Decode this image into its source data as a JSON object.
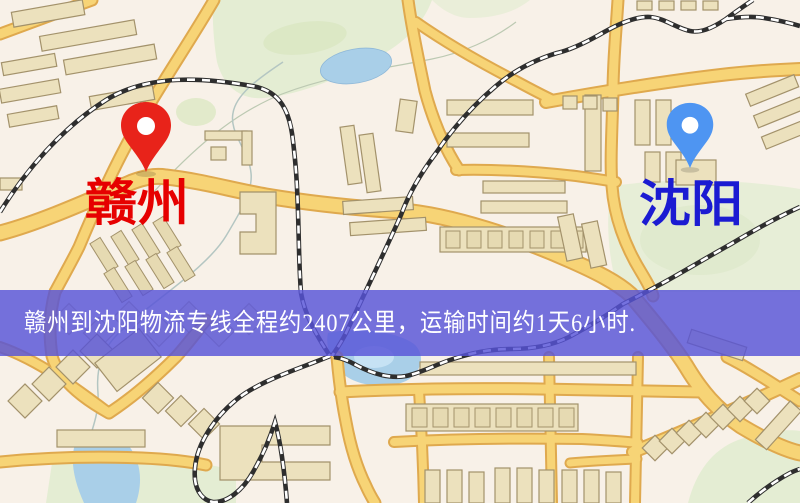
{
  "banner": {
    "text": "赣州到沈阳物流专线全程约2407公里，运输时间约1天6小时.",
    "background_color": "#5753d8",
    "text_color": "#ffffff"
  },
  "markers": {
    "origin": {
      "label": "赣州",
      "pin_color": "#e8231a",
      "label_color": "#e60000"
    },
    "destination": {
      "label": "沈阳",
      "pin_color": "#4e95f2",
      "label_color": "#1b1bd2"
    }
  },
  "route": {
    "origin": "赣州",
    "destination": "沈阳",
    "service": "物流专线",
    "distance_text": "全程约2407公里",
    "duration_text": "运输时间约1天6小时"
  },
  "map_palette": {
    "background": "#f8f1e8",
    "road_fill": "#f7d476",
    "road_casing": "#dfa94e",
    "park": "#e4edd3",
    "water": "#a9cfe8",
    "building_fill": "#ece1bd",
    "building_stroke": "#a3926b",
    "railway": "#2e2e2e"
  }
}
